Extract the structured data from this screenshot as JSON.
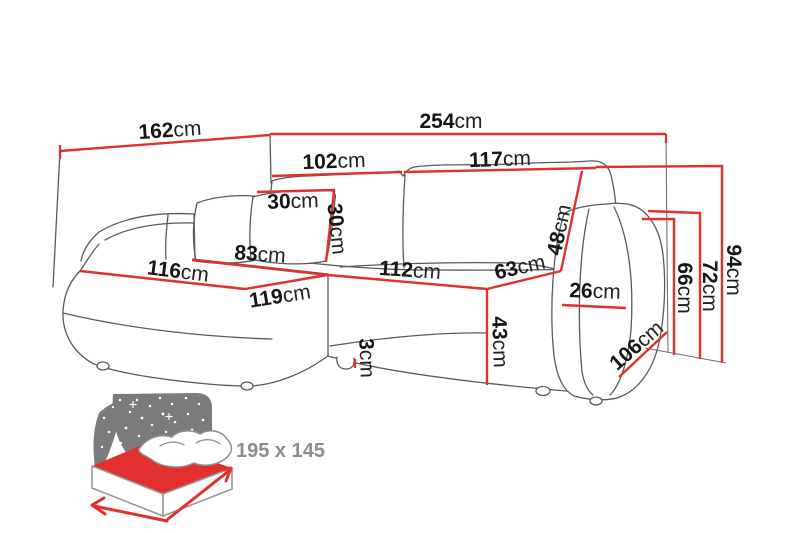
{
  "page": {
    "background": "#ffffff"
  },
  "colors": {
    "dimension_red": "#e2302e",
    "sofa_outline_gray": "#5a5a5e",
    "icon_gray": "#7b7b7d",
    "bed_size_text_gray": "#8d8d8f",
    "label_black": "#161616"
  },
  "diagram": {
    "type": "corner-sofa-dimension-drawing",
    "unit": "cm",
    "dimensions": {
      "corner_side_width": {
        "value": "162",
        "unit": "cm"
      },
      "total_width": {
        "value": "254",
        "unit": "cm"
      },
      "back_cushion_left_width": {
        "value": "102",
        "unit": "cm"
      },
      "back_cushion_right_width": {
        "value": "117",
        "unit": "cm"
      },
      "pillow_width": {
        "value": "30",
        "unit": "cm"
      },
      "pillow_height": {
        "value": "30",
        "unit": "cm"
      },
      "chaise_back_width": {
        "value": "83",
        "unit": "cm"
      },
      "chaise_seat_width": {
        "value": "116",
        "unit": "cm"
      },
      "chaise_front_width": {
        "value": "119",
        "unit": "cm"
      },
      "seat_front_width": {
        "value": "112",
        "unit": "cm"
      },
      "seat_depth": {
        "value": "63",
        "unit": "cm"
      },
      "backrest_cushion_height": {
        "value": "48",
        "unit": "cm"
      },
      "armrest_top_width": {
        "value": "26",
        "unit": "cm"
      },
      "seat_height": {
        "value": "43",
        "unit": "cm"
      },
      "leg_height": {
        "value": "3",
        "unit": "cm"
      },
      "armrest_length": {
        "value": "106",
        "unit": "cm"
      },
      "armrest_height": {
        "value": "66",
        "unit": "cm"
      },
      "back_height": {
        "value": "72",
        "unit": "cm"
      },
      "total_height": {
        "value": "94",
        "unit": "cm"
      }
    },
    "sleep_function": {
      "bed_size": "195 x 145",
      "icons": {
        "night_sky": "night-sky-stars-icon",
        "bed": "fold-out-bed-icon",
        "width_arrow": "bed-width-arrow-icon",
        "depth_arrow": "bed-depth-arrow-icon"
      }
    }
  }
}
